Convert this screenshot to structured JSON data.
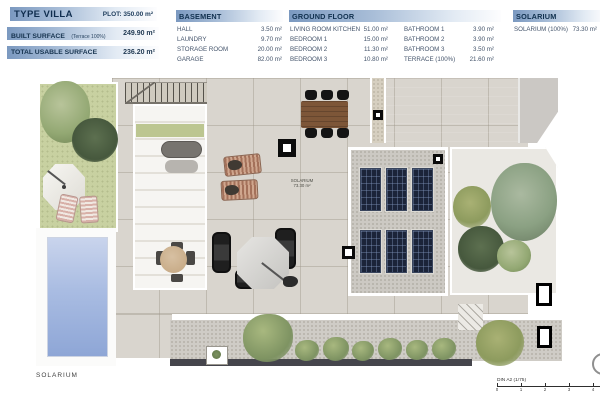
{
  "header": {
    "villa": {
      "title": "TYPE VILLA",
      "plot": "PLOT: 350.00 m²",
      "built_label": "BUILT SURFACE",
      "built_note": "(Terrace 100%)",
      "built_value": "249.90 m²",
      "total_label": "TOTAL USABLE SURFACE",
      "total_value": "236.20 m²"
    },
    "basement": {
      "title": "BASEMENT",
      "rows": [
        {
          "label": "HALL",
          "value": "3.50 m²"
        },
        {
          "label": "LAUNDRY",
          "value": "9.70 m²"
        },
        {
          "label": "STORAGE ROOM",
          "value": "20.00 m²"
        },
        {
          "label": "GARAGE",
          "value": "82.00 m²"
        }
      ]
    },
    "ground_floor": {
      "title": "GROUND FLOOR",
      "left_rows": [
        {
          "label": "LIVING ROOM KITCHEN",
          "value": "51.00 m²"
        },
        {
          "label": "BEDROOM 1",
          "value": "15.00 m²"
        },
        {
          "label": "BEDROOM 2",
          "value": "11.30 m²"
        },
        {
          "label": "BEDROOM 3",
          "value": "10.80 m²"
        }
      ],
      "right_rows": [
        {
          "label": "BATHROOM 1",
          "value": "3.90 m²"
        },
        {
          "label": "BATHROOM 2",
          "value": "3.90 m²"
        },
        {
          "label": "BATHROOM 3",
          "value": "3.50 m²"
        },
        {
          "label": "TERRACE (100%)",
          "value": "21.60 m²"
        }
      ]
    },
    "solarium": {
      "title": "SOLARIUM",
      "rows": [
        {
          "label": "SOLARIUM (100%)",
          "value": "73.30 m²"
        }
      ]
    }
  },
  "plan": {
    "solarium_floor_label": "SOLARIUM",
    "center_label_line1": "SOLARIUM",
    "center_label_line2": "73.30 m²",
    "scale": {
      "caption": "DIN A2 (1/75)",
      "ticks": [
        "0",
        "1",
        "2",
        "3",
        "4"
      ]
    },
    "colors": {
      "header_bar_blue": "#7b99c0",
      "header_text_navy": "#10304e",
      "terrace_tile": "#d9d5ce",
      "grass": "#c8d1a1",
      "pool_blue": "#9db4de",
      "solar_panel_navy": "#1b2439",
      "wood_table": "#7d5638"
    }
  }
}
